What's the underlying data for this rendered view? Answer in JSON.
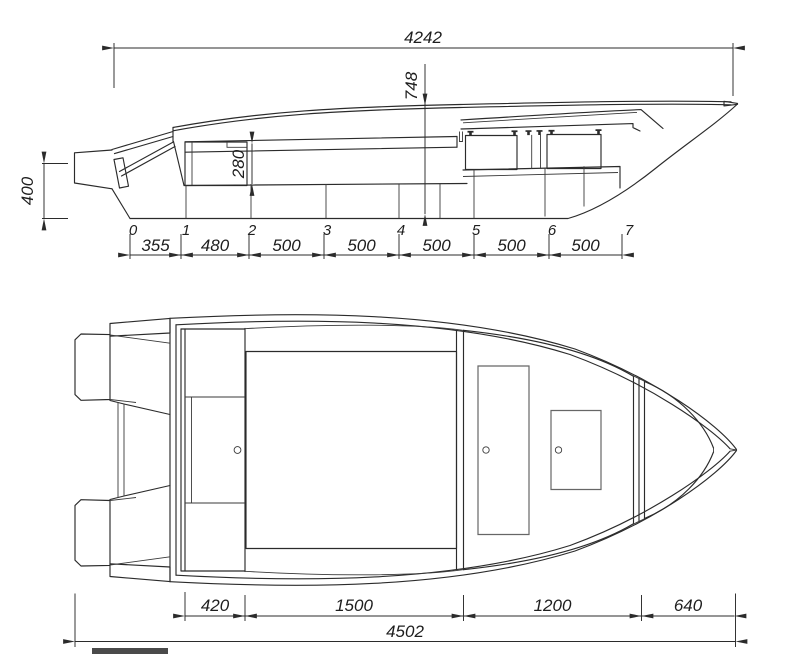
{
  "side_view": {
    "overall_length": "4242",
    "bow_height": "748",
    "cockpit_depth": "280",
    "transom_height": "400",
    "stations": [
      "0",
      "1",
      "2",
      "3",
      "4",
      "5",
      "6",
      "7"
    ],
    "spacings": [
      "355",
      "480",
      "500",
      "500",
      "500",
      "500",
      "500"
    ]
  },
  "plan_view": {
    "segments": [
      "420",
      "1500",
      "1200",
      "640"
    ],
    "overall_length": "4502"
  }
}
